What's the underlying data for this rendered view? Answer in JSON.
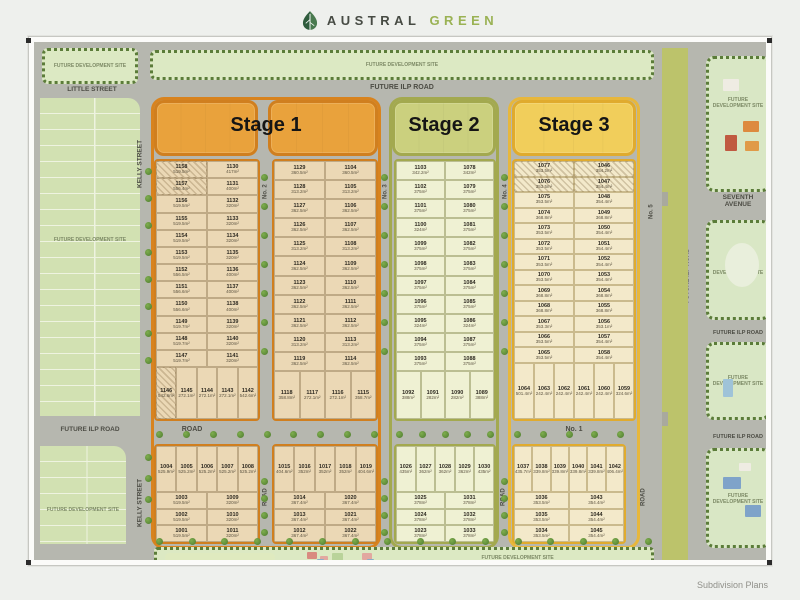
{
  "brand": {
    "word1": "AUSTRAL",
    "word2": "GREEN"
  },
  "caption": "Subdivision Plans",
  "labels": {
    "future_dev": "FUTURE DEVELOPMENT SITE",
    "future_ilp": "FUTURE ILP ROAD",
    "little": "LITTLE STREET",
    "kelly": "KELLY STREET",
    "seventh": "SEVENTH AVENUE",
    "road": "ROAD",
    "no1": "No. 1",
    "no2": "No. 2",
    "no3": "No. 3",
    "no4": "No. 4",
    "no5": "No. 5"
  },
  "stages": {
    "s1": "Stage 1",
    "s2": "Stage 2",
    "s3": "Stage 3"
  },
  "colors": {
    "stage1": "#e9a23c",
    "stage2": "#cbd07e",
    "stage3": "#f1ce5b",
    "brand_green": "#9ab254"
  },
  "blocks": {
    "s1_left": {
      "left": [
        {
          "n": "1158",
          "a": "519.5m²",
          "h": 1
        },
        {
          "n": "1157",
          "a": "556.4m²",
          "h": 1
        },
        {
          "n": "1156",
          "a": "519.5m²"
        },
        {
          "n": "1155",
          "a": "519.5m²"
        },
        {
          "n": "1154",
          "a": "519.5m²"
        },
        {
          "n": "1153",
          "a": "519.5m²"
        },
        {
          "n": "1152",
          "a": "556.5m²"
        },
        {
          "n": "1151",
          "a": "556.6m²"
        },
        {
          "n": "1150",
          "a": "556.6m²"
        },
        {
          "n": "1149",
          "a": "519.7m²"
        },
        {
          "n": "1148",
          "a": "519.7m²"
        },
        {
          "n": "1147",
          "a": "519.7m²"
        }
      ],
      "right": [
        {
          "n": "1130",
          "a": "417m²"
        },
        {
          "n": "1131",
          "a": "400m²"
        },
        {
          "n": "1132",
          "a": "320m²"
        },
        {
          "n": "1133",
          "a": "320m²"
        },
        {
          "n": "1134",
          "a": "320m²"
        },
        {
          "n": "1135",
          "a": "320m²"
        },
        {
          "n": "1136",
          "a": "400m²"
        },
        {
          "n": "1137",
          "a": "400m²"
        },
        {
          "n": "1138",
          "a": "400m²"
        },
        {
          "n": "1139",
          "a": "320m²"
        },
        {
          "n": "1140",
          "a": "320m²"
        },
        {
          "n": "1141",
          "a": "320m²"
        }
      ],
      "bottom": [
        {
          "n": "1146",
          "a": "542.6m²",
          "h": 1
        },
        {
          "n": "1145",
          "a": "272.1m²"
        },
        {
          "n": "1144",
          "a": "272.1m²"
        },
        {
          "n": "1143",
          "a": "272.1m²"
        },
        {
          "n": "1142",
          "a": "542.6m²"
        }
      ]
    },
    "s1_right": {
      "left": [
        {
          "n": "1129",
          "a": "360.5m²"
        },
        {
          "n": "1128",
          "a": "313.2m²"
        },
        {
          "n": "1127",
          "a": "362.5m²"
        },
        {
          "n": "1126",
          "a": "362.5m²"
        },
        {
          "n": "1125",
          "a": "313.2m²"
        },
        {
          "n": "1124",
          "a": "362.5m²"
        },
        {
          "n": "1123",
          "a": "362.5m²"
        },
        {
          "n": "1122",
          "a": "362.5m²"
        },
        {
          "n": "1121",
          "a": "362.5m²"
        },
        {
          "n": "1120",
          "a": "313.2m²"
        },
        {
          "n": "1119",
          "a": "362.5m²"
        }
      ],
      "right": [
        {
          "n": "1104",
          "a": "360.5m²"
        },
        {
          "n": "1105",
          "a": "313.2m²"
        },
        {
          "n": "1106",
          "a": "362.5m²"
        },
        {
          "n": "1107",
          "a": "362.5m²"
        },
        {
          "n": "1108",
          "a": "313.2m²"
        },
        {
          "n": "1109",
          "a": "362.5m²"
        },
        {
          "n": "1110",
          "a": "362.5m²"
        },
        {
          "n": "1111",
          "a": "362.5m²"
        },
        {
          "n": "1112",
          "a": "362.5m²"
        },
        {
          "n": "1113",
          "a": "313.2m²"
        },
        {
          "n": "1114",
          "a": "362.5m²"
        }
      ],
      "bottom": [
        {
          "n": "1118",
          "a": "358.8m²"
        },
        {
          "n": "1117",
          "a": "272.1m²"
        },
        {
          "n": "1116",
          "a": "272.1m²"
        },
        {
          "n": "1115",
          "a": "358.7m²"
        }
      ]
    },
    "s2_main": {
      "left": [
        {
          "n": "1103",
          "a": "342.2m²"
        },
        {
          "n": "1102",
          "a": "375m²"
        },
        {
          "n": "1101",
          "a": "375m²"
        },
        {
          "n": "1100",
          "a": "324m²"
        },
        {
          "n": "1099",
          "a": "375m²"
        },
        {
          "n": "1098",
          "a": "375m²"
        },
        {
          "n": "1097",
          "a": "375m²"
        },
        {
          "n": "1096",
          "a": "375m²"
        },
        {
          "n": "1095",
          "a": "324m²"
        },
        {
          "n": "1094",
          "a": "375m²"
        },
        {
          "n": "1093",
          "a": "375m²"
        }
      ],
      "right": [
        {
          "n": "1078",
          "a": "342m²"
        },
        {
          "n": "1079",
          "a": "375m²"
        },
        {
          "n": "1080",
          "a": "375m²"
        },
        {
          "n": "1081",
          "a": "375m²"
        },
        {
          "n": "1082",
          "a": "375m²"
        },
        {
          "n": "1083",
          "a": "375m²"
        },
        {
          "n": "1084",
          "a": "375m²"
        },
        {
          "n": "1085",
          "a": "375m²"
        },
        {
          "n": "1086",
          "a": "324m²"
        },
        {
          "n": "1087",
          "a": "375m²"
        },
        {
          "n": "1088",
          "a": "375m²"
        }
      ],
      "bottom": [
        {
          "n": "1092",
          "a": "388m²"
        },
        {
          "n": "1091",
          "a": "282m²"
        },
        {
          "n": "1090",
          "a": "282m²"
        },
        {
          "n": "1089",
          "a": "388m²"
        }
      ]
    },
    "s3_main": {
      "left": [
        {
          "n": "1077",
          "a": "353.5m²",
          "h": 1
        },
        {
          "n": "1076",
          "a": "353.5m²",
          "h": 1
        },
        {
          "n": "1075",
          "a": "353.5m²"
        },
        {
          "n": "1074",
          "a": "368.8m²"
        },
        {
          "n": "1073",
          "a": "353.5m²"
        },
        {
          "n": "1072",
          "a": "353.5m²"
        },
        {
          "n": "1071",
          "a": "353.5m²"
        },
        {
          "n": "1070",
          "a": "353.5m²"
        },
        {
          "n": "1069",
          "a": "368.8m²"
        },
        {
          "n": "1068",
          "a": "368.8m²"
        },
        {
          "n": "1067",
          "a": "353.3m²"
        },
        {
          "n": "1066",
          "a": "353.5m²"
        },
        {
          "n": "1065",
          "a": "353.5m²"
        }
      ],
      "right": [
        {
          "n": "1046",
          "a": "354.2m²",
          "h": 1
        },
        {
          "n": "1047",
          "a": "354.4m²",
          "h": 1
        },
        {
          "n": "1048",
          "a": "354.4m²"
        },
        {
          "n": "1049",
          "a": "368.8m²"
        },
        {
          "n": "1050",
          "a": "354.4m²"
        },
        {
          "n": "1051",
          "a": "354.4m²"
        },
        {
          "n": "1052",
          "a": "354.4m²"
        },
        {
          "n": "1053",
          "a": "354.4m²"
        },
        {
          "n": "1054",
          "a": "368.8m²"
        },
        {
          "n": "1055",
          "a": "368.8m²"
        },
        {
          "n": "1056",
          "a": "353.1m²"
        },
        {
          "n": "1057",
          "a": "354.4m²"
        },
        {
          "n": "1058",
          "a": "354.4m²"
        }
      ],
      "bottom": [
        {
          "n": "1064",
          "a": "501.4m²"
        },
        {
          "n": "1063",
          "a": "242.4m²"
        },
        {
          "n": "1062",
          "a": "242.4m²"
        },
        {
          "n": "1061",
          "a": "242.4m²"
        },
        {
          "n": "1060",
          "a": "242.4m²"
        },
        {
          "n": "1059",
          "a": "324.6m²"
        }
      ]
    },
    "s1_bl": {
      "top": [
        {
          "n": "1004",
          "a": "525.9m²"
        },
        {
          "n": "1005",
          "a": "525.2m²"
        },
        {
          "n": "1006",
          "a": "525.2m²"
        },
        {
          "n": "1007",
          "a": "525.2m²"
        },
        {
          "n": "1008",
          "a": "525.2m²"
        }
      ],
      "left": [
        {
          "n": "1003",
          "a": "519.5m²"
        },
        {
          "n": "1002",
          "a": "519.5m²"
        },
        {
          "n": "1001",
          "a": "519.5m²"
        }
      ],
      "right": [
        {
          "n": "1009",
          "a": "320m²"
        },
        {
          "n": "1010",
          "a": "320m²"
        },
        {
          "n": "1011",
          "a": "320m²"
        }
      ]
    },
    "s1_br": {
      "top": [
        {
          "n": "1015",
          "a": "404.6m²"
        },
        {
          "n": "1016",
          "a": "352m²"
        },
        {
          "n": "1017",
          "a": "352m²"
        },
        {
          "n": "1018",
          "a": "352m²"
        },
        {
          "n": "1019",
          "a": "404.6m²"
        }
      ],
      "left": [
        {
          "n": "1014",
          "a": "367.4m²"
        },
        {
          "n": "1013",
          "a": "367.4m²"
        },
        {
          "n": "1012",
          "a": "367.4m²"
        }
      ],
      "right": [
        {
          "n": "1020",
          "a": "367.4m²"
        },
        {
          "n": "1021",
          "a": "367.4m²"
        },
        {
          "n": "1022",
          "a": "367.4m²"
        }
      ]
    },
    "s2_b": {
      "top": [
        {
          "n": "1026",
          "a": "435m²"
        },
        {
          "n": "1027",
          "a": "362m²"
        },
        {
          "n": "1028",
          "a": "362m²"
        },
        {
          "n": "1029",
          "a": "362m²"
        },
        {
          "n": "1030",
          "a": "435m²"
        }
      ],
      "left": [
        {
          "n": "1025",
          "a": "378m²"
        },
        {
          "n": "1024",
          "a": "378m²"
        },
        {
          "n": "1023",
          "a": "378m²"
        }
      ],
      "right": [
        {
          "n": "1031",
          "a": "378m²"
        },
        {
          "n": "1032",
          "a": "378m²"
        },
        {
          "n": "1033",
          "a": "378m²"
        }
      ]
    },
    "s3_b": {
      "top": [
        {
          "n": "1037",
          "a": "435.7m²"
        },
        {
          "n": "1038",
          "a": "339.8m²"
        },
        {
          "n": "1039",
          "a": "339.8m²"
        },
        {
          "n": "1040",
          "a": "339.8m²"
        },
        {
          "n": "1041",
          "a": "339.8m²"
        },
        {
          "n": "1042",
          "a": "406.4m²"
        }
      ],
      "left": [
        {
          "n": "1036",
          "a": "353.5m²"
        },
        {
          "n": "1035",
          "a": "353.5m²"
        },
        {
          "n": "1034",
          "a": "353.5m²"
        }
      ],
      "right": [
        {
          "n": "1043",
          "a": "354.4m²"
        },
        {
          "n": "1044",
          "a": "354.4m²"
        },
        {
          "n": "1045",
          "a": "354.4m²"
        }
      ]
    }
  }
}
